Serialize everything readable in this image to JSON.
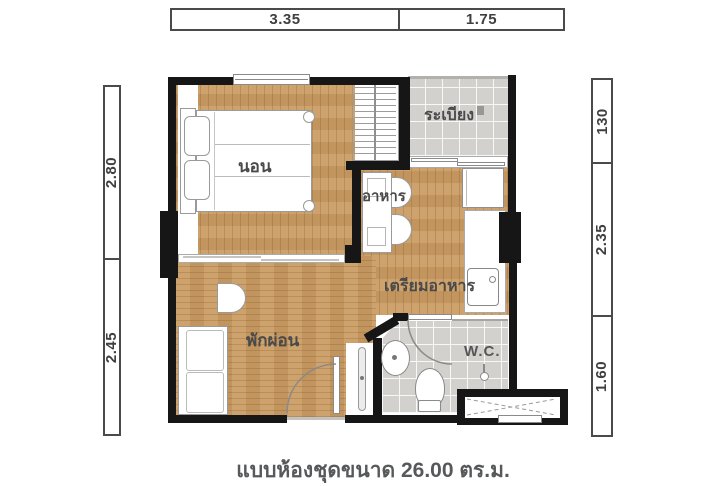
{
  "caption": "แบบห้องชุดขนาด 26.00 ตร.ม.",
  "dims": {
    "top": [
      "3.35",
      "1.75"
    ],
    "left": [
      "2.80",
      "2.45"
    ],
    "right": [
      "130",
      "2.35",
      "1.60"
    ]
  },
  "rooms": {
    "bedroom": "นอน",
    "balcony": "ระเบียง",
    "dining": "อาหาร",
    "kitchen": "เตรียมอาหาร",
    "living": "พักผ่อน",
    "wc": "W.C."
  },
  "colors": {
    "wall": "#161616",
    "wood": "#cb9c63",
    "tile": "#d3d1ce",
    "dim_text": "#3f3f3f",
    "caption_text": "#57585a"
  }
}
